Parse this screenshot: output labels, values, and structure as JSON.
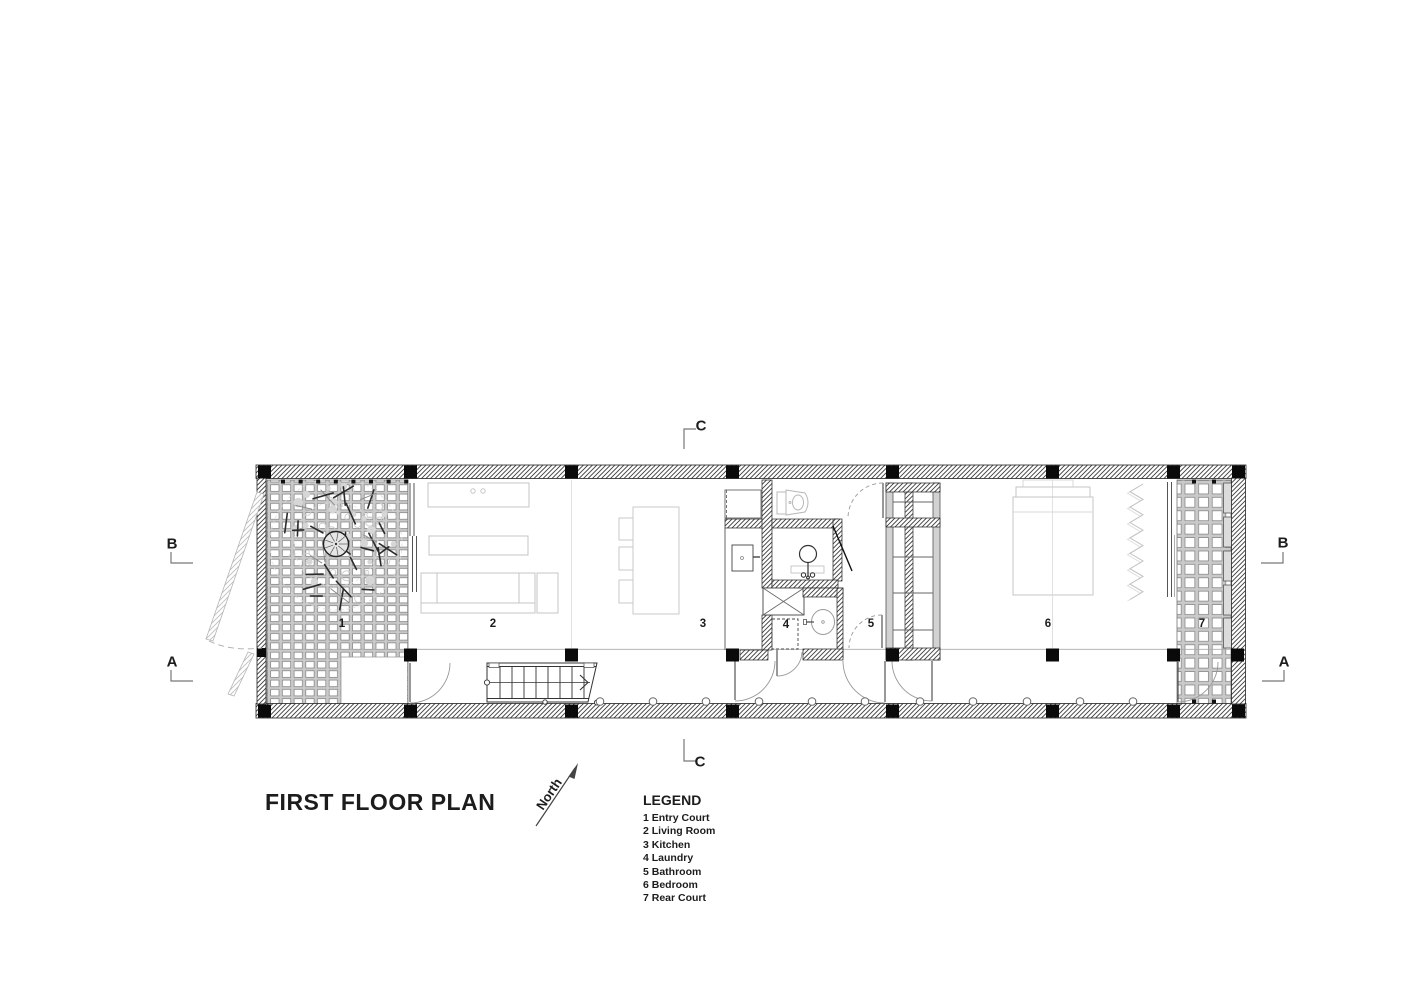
{
  "drawing": {
    "title": "FIRST FLOOR PLAN",
    "north_label": "North",
    "legend_heading": "LEGEND",
    "rooms": [
      {
        "num": "1",
        "name": "Entry Court"
      },
      {
        "num": "2",
        "name": "Living Room"
      },
      {
        "num": "3",
        "name": "Kitchen"
      },
      {
        "num": "4",
        "name": "Laundry"
      },
      {
        "num": "5",
        "name": "Bathroom"
      },
      {
        "num": "6",
        "name": "Bedroom"
      },
      {
        "num": "7",
        "name": "Rear Court"
      }
    ],
    "section_markers": {
      "top": "C",
      "bottom": "C",
      "left_upper": "B",
      "left_lower": "A",
      "right_upper": "B",
      "right_lower": "A"
    },
    "colors": {
      "ink": "#1c1c1c",
      "wall_hatch": "#3c3c3c",
      "furniture_gray": "#c6c6c6"
    }
  }
}
